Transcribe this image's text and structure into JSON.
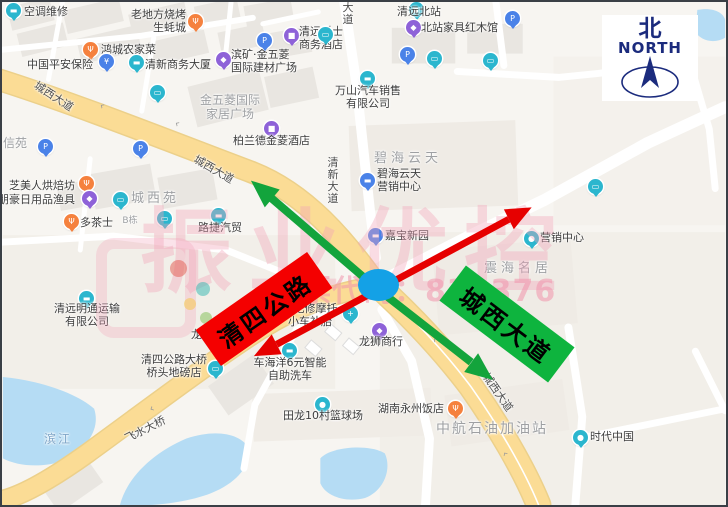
{
  "map": {
    "watermark": {
      "line1": "振业优控",
      "line2": "股票代码：839376"
    },
    "north_badge": {
      "cn": "北",
      "en": "NORTH",
      "color": "#1b2b7d"
    },
    "annotations": {
      "road_label_red": {
        "text": "清四公路",
        "bg": "#f40000"
      },
      "road_label_green": {
        "text": "城西大道",
        "bg": "#0eb43e"
      },
      "arrow_red_color": "#e60000",
      "arrow_green_color": "#13a43c",
      "intersection_marker_color": "#14a1e6"
    },
    "colors": {
      "teal": "#2bb6ce",
      "blue": "#4a82e8",
      "purple": "#8e62d8",
      "orange": "#f5813e"
    },
    "road_labels": [
      {
        "t": "城西大道",
        "x": 52,
        "y": 94,
        "r": 33
      },
      {
        "t": "城西大道",
        "x": 212,
        "y": 167,
        "r": 30
      },
      {
        "t": "城西大道",
        "x": 496,
        "y": 390,
        "r": 55
      },
      {
        "t": "清新大道",
        "x": 331,
        "y": 179,
        "v": 1
      },
      {
        "t": "大道",
        "x": 346,
        "y": 12,
        "v": 1
      },
      {
        "t": "飞水大桥",
        "x": 143,
        "y": 427,
        "r": -27
      }
    ],
    "dir_arrows": [
      {
        "x": 100,
        "y": 104,
        "r": 33
      },
      {
        "x": 175,
        "y": 122,
        "r": 31
      },
      {
        "x": 433,
        "y": 338,
        "r": 42
      },
      {
        "x": 503,
        "y": 452,
        "r": 57
      },
      {
        "x": 150,
        "y": 407,
        "r": -27
      }
    ],
    "area_labels": [
      {
        "t": [
          "金五菱国际",
          "家居广场"
        ],
        "x": 228,
        "y": 92,
        "fs": 12
      },
      {
        "t": [
          "城西苑"
        ],
        "x": 153,
        "y": 190,
        "fs": 13,
        "ls": 3
      },
      {
        "t": [
          "B栋"
        ],
        "x": 128,
        "y": 214,
        "fs": 9
      },
      {
        "t": [
          "碧海云天"
        ],
        "x": 406,
        "y": 150,
        "fs": 13,
        "ls": 4
      },
      {
        "t": [
          "震海名居"
        ],
        "x": 516,
        "y": 260,
        "fs": 13,
        "ls": 4
      },
      {
        "t": [
          "中航石油加油站"
        ],
        "x": 490,
        "y": 419,
        "fs": 14,
        "ls": 2
      },
      {
        "t": [
          "滨江"
        ],
        "x": 56,
        "y": 431,
        "fs": 12,
        "ls": 2,
        "c": "#7fa6c8"
      },
      {
        "t": [
          "信苑"
        ],
        "x": 13,
        "y": 135,
        "fs": 12
      },
      {
        "t": [
          "龙兴"
        ],
        "x": 200,
        "y": 327,
        "fs": 11,
        "c": "#3d3d3d"
      }
    ],
    "pois": [
      {
        "g": "▬",
        "c": "teal",
        "ix": 4,
        "iy": 1,
        "lines": [
          "空调维修"
        ],
        "lx": 22,
        "ly": 4,
        "a": "s"
      },
      {
        "g": "Ψ",
        "c": "orange",
        "ix": 186,
        "iy": 12,
        "lines": [
          "老地方烧烤",
          "生蚝城"
        ],
        "lx": 184,
        "ly": 7,
        "a": "e"
      },
      {
        "g": "Ψ",
        "c": "orange",
        "ix": 81,
        "iy": 40,
        "lines": [
          "鸿城农家菜"
        ],
        "lx": 99,
        "ly": 42,
        "a": "s"
      },
      {
        "g": "¥",
        "c": "blue",
        "ix": 97,
        "iy": 52,
        "lines": [
          "中国平安保险"
        ],
        "lx": 91,
        "ly": 57,
        "a": "e"
      },
      {
        "g": "▬",
        "c": "teal",
        "ix": 127,
        "iy": 53,
        "lines": [
          "清新商务大厦"
        ],
        "lx": 143,
        "ly": 57,
        "a": "s"
      },
      {
        "g": "◆",
        "c": "purple",
        "ix": 214,
        "iy": 50,
        "lines": [
          "滨矿·金五菱",
          "国际建材广场"
        ],
        "lx": 229,
        "ly": 47,
        "a": "s"
      },
      {
        "g": "■",
        "c": "purple",
        "ix": 262,
        "iy": 119,
        "lines": [
          "柏兰德金菱酒店"
        ],
        "lx": 231,
        "ly": 133,
        "a": "s"
      },
      {
        "g": "■",
        "c": "purple",
        "ix": 282,
        "iy": 26,
        "lines": [
          "清远爵士",
          "商务酒店"
        ],
        "lx": 297,
        "ly": 24,
        "a": "s"
      },
      {
        "g": "P",
        "c": "blue",
        "ix": 255,
        "iy": 31,
        "lines": []
      },
      {
        "g": "P",
        "c": "blue",
        "ix": 131,
        "iy": 139,
        "lines": []
      },
      {
        "g": "P",
        "c": "blue",
        "ix": 398,
        "iy": 45,
        "lines": []
      },
      {
        "g": "P",
        "c": "blue",
        "ix": 503,
        "iy": 9,
        "lines": []
      },
      {
        "g": "P",
        "c": "blue",
        "ix": 36,
        "iy": 137,
        "lines": []
      },
      {
        "g": "▭",
        "c": "teal",
        "ix": 148,
        "iy": 83,
        "lines": []
      },
      {
        "g": "▭",
        "c": "teal",
        "ix": 316,
        "iy": 25,
        "lines": []
      },
      {
        "g": "▭",
        "c": "teal",
        "ix": 425,
        "iy": 49,
        "lines": []
      },
      {
        "g": "▭",
        "c": "teal",
        "ix": 481,
        "iy": 51,
        "lines": []
      },
      {
        "g": "▭",
        "c": "teal",
        "ix": 111,
        "iy": 190,
        "lines": []
      },
      {
        "g": "▭",
        "c": "teal",
        "ix": 155,
        "iy": 209,
        "lines": []
      },
      {
        "g": "▭",
        "c": "teal",
        "ix": 586,
        "iy": 177,
        "lines": []
      },
      {
        "g": "▬",
        "c": "teal",
        "ix": 209,
        "iy": 206,
        "lines": [
          "路捷汽贸"
        ],
        "lx": 218,
        "ly": 220,
        "a": "m"
      },
      {
        "g": "▣",
        "c": "teal",
        "ix": 407,
        "iy": 0,
        "lines": [
          "清远北站"
        ],
        "lx": 417,
        "ly": 4,
        "a": "m"
      },
      {
        "g": "◆",
        "c": "purple",
        "ix": 404,
        "iy": 18,
        "lines": [
          "北站家具红木馆"
        ],
        "lx": 419,
        "ly": 20,
        "a": "s"
      },
      {
        "g": "▬",
        "c": "teal",
        "ix": 358,
        "iy": 69,
        "lines": [
          "万山汽车销售",
          "有限公司"
        ],
        "lx": 366,
        "ly": 83,
        "a": "m"
      },
      {
        "g": "Ψ",
        "c": "orange",
        "ix": 77,
        "iy": 174,
        "lines": [
          "芝美人烘焙坊"
        ],
        "lx": 73,
        "ly": 178,
        "a": "e"
      },
      {
        "g": "◆",
        "c": "purple",
        "ix": 80,
        "iy": 189,
        "lines": [
          "朋豪日用品渔具"
        ],
        "lx": 73,
        "ly": 192,
        "a": "e"
      },
      {
        "g": "Ψ",
        "c": "orange",
        "ix": 62,
        "iy": 212,
        "lines": [
          "多茶士"
        ],
        "lx": 78,
        "ly": 215,
        "a": "s"
      },
      {
        "g": "▬",
        "c": "teal",
        "ix": 77,
        "iy": 289,
        "lines": [
          "清远明通运输",
          "有限公司"
        ],
        "lx": 85,
        "ly": 301,
        "a": "m"
      },
      {
        "g": "▭",
        "c": "teal",
        "ix": 206,
        "iy": 359,
        "lines": [
          "清四公路大桥",
          "桥头地磅店"
        ],
        "lx": 172,
        "ly": 352,
        "a": "m"
      },
      {
        "g": "+",
        "c": "teal",
        "ix": 341,
        "iy": 304,
        "lines": [
          "强记修摩托",
          "小车补胎"
        ],
        "lx": 308,
        "ly": 301,
        "a": "m"
      },
      {
        "g": "◆",
        "c": "purple",
        "ix": 370,
        "iy": 321,
        "lines": [
          "龙狮商行"
        ],
        "lx": 379,
        "ly": 334,
        "a": "m"
      },
      {
        "g": "▬",
        "c": "teal",
        "ix": 280,
        "iy": 341,
        "lines": [
          "车海洋6元智能",
          "自助洗车"
        ],
        "lx": 288,
        "ly": 355,
        "a": "m"
      },
      {
        "g": "●",
        "c": "teal",
        "ix": 313,
        "iy": 395,
        "lines": [
          "田龙10村篮球场"
        ],
        "lx": 321,
        "ly": 408,
        "a": "m"
      },
      {
        "g": "Ψ",
        "c": "orange",
        "ix": 446,
        "iy": 399,
        "lines": [
          "湖南永州饭店"
        ],
        "lx": 442,
        "ly": 401,
        "a": "e"
      },
      {
        "g": "●",
        "c": "teal",
        "ix": 571,
        "iy": 428,
        "lines": [
          "时代中国"
        ],
        "lx": 588,
        "ly": 429,
        "a": "s"
      },
      {
        "g": "▬",
        "c": "blue",
        "ix": 366,
        "iy": 226,
        "lines": [
          "嘉宝新园"
        ],
        "lx": 383,
        "ly": 228,
        "a": "s"
      },
      {
        "g": "▬",
        "c": "blue",
        "ix": 358,
        "iy": 171,
        "lines": [
          "碧海云天",
          "营销中心"
        ],
        "lx": 375,
        "ly": 166,
        "a": "s"
      },
      {
        "g": "●",
        "c": "teal",
        "ix": 522,
        "iy": 229,
        "lines": [
          "营销中心"
        ],
        "lx": 538,
        "ly": 230,
        "a": "s"
      }
    ]
  }
}
